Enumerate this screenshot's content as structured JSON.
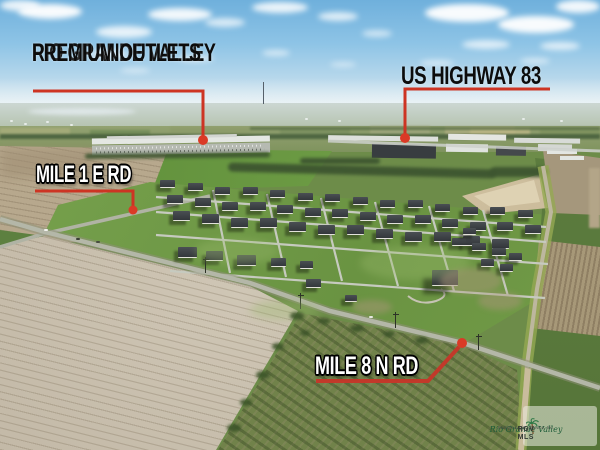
{
  "annotations": {
    "outlets": {
      "line1": "RIO GRANDE VALLEY",
      "line2": "PREMIUM OUTLETS"
    },
    "highway": {
      "label": "US HIGHWAY 83"
    },
    "mile1_rd": {
      "label": "MILE 1 E RD"
    },
    "mile8_rd": {
      "label": "MILE 8 N RD"
    }
  },
  "watermark": {
    "icon": "palm-tree-icon",
    "brand": "Rio Grande Valley",
    "subtitle": "Multiple Listing Service, Inc.",
    "abbr": "RGV MLS"
  },
  "colors": {
    "annotation_red": "#cd3423",
    "annotation_dot_red": "#da3a26",
    "label_black": "#0c0c0c",
    "label_white": "#ffffff",
    "sky_blue": "#8ec4e6",
    "plowed_field_tan": "#c7bdac",
    "grass_green": "#6a9342"
  }
}
